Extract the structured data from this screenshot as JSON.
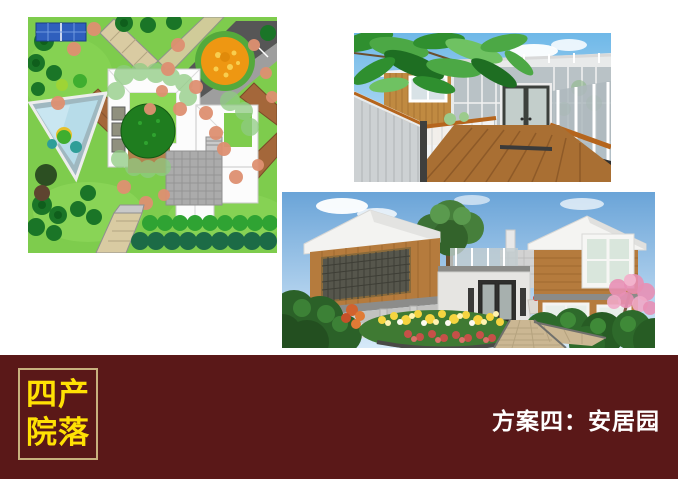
{
  "footer": {
    "background_color": "#5A1818",
    "badge": {
      "border_color": "#C8B17E",
      "text_color": "#FFE104",
      "line1": "四产",
      "line2": "院落"
    },
    "caption": {
      "text": "方案四：安居园",
      "color": "#FFFFFF"
    }
  }
}
